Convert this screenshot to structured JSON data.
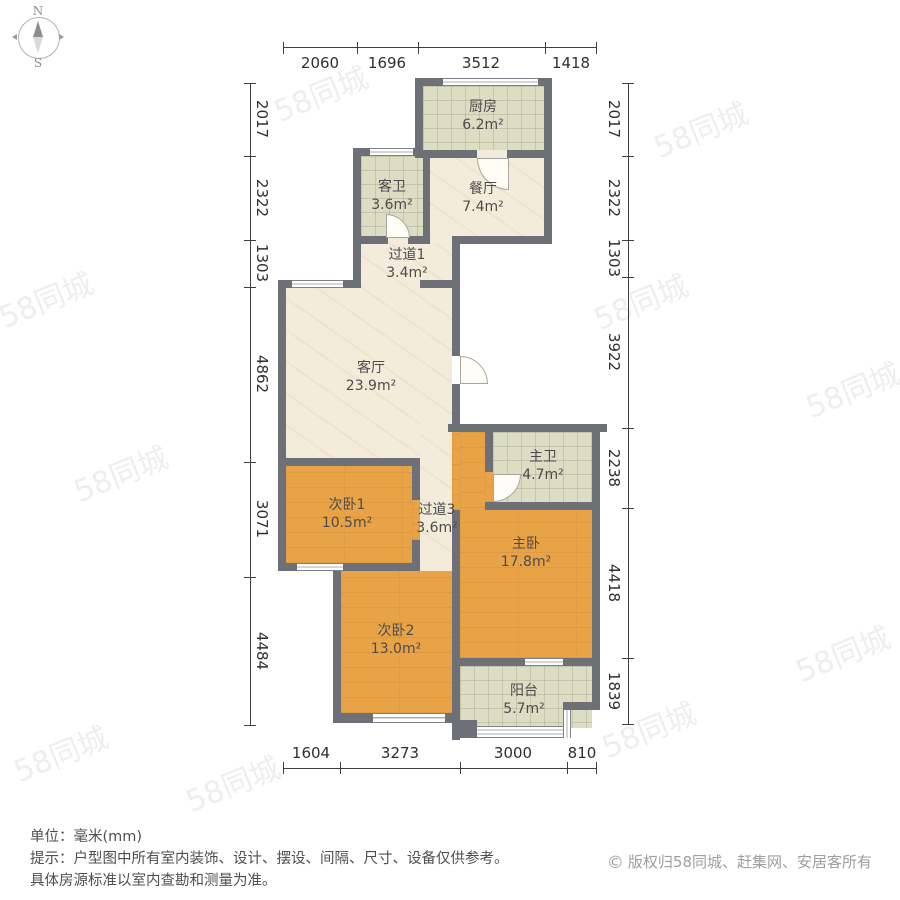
{
  "compass": {
    "north": "N",
    "south": "S"
  },
  "watermark": {
    "text": "58同城"
  },
  "colors": {
    "wall": "#6d7177",
    "wood_floor": "#e8a347",
    "tile_floor": "#dcddc3",
    "marble_floor": "#f3ecda",
    "dimension_text": "#2f2f2f",
    "footer_text": "#4f4f4f",
    "copyright_text": "#9e9e9e"
  },
  "rooms": {
    "kitchen": {
      "name": "厨房",
      "area": "6.2m²"
    },
    "guest_bath": {
      "name": "客卫",
      "area": "3.6m²"
    },
    "dining": {
      "name": "餐厅",
      "area": "7.4m²"
    },
    "hallway1": {
      "name": "过道1",
      "area": "3.4m²"
    },
    "living": {
      "name": "客厅",
      "area": "23.9m²"
    },
    "bedroom1": {
      "name": "次卧1",
      "area": "10.5m²"
    },
    "hallway3": {
      "name": "过道3",
      "area": "3.6m²"
    },
    "master_bath": {
      "name": "主卫",
      "area": "4.7m²"
    },
    "master_bedroom": {
      "name": "主卧",
      "area": "17.8m²"
    },
    "bedroom2": {
      "name": "次卧2",
      "area": "13.0m²"
    },
    "balcony": {
      "name": "阳台",
      "area": "5.7m²"
    }
  },
  "dims": {
    "top": [
      "2060",
      "1696",
      "3512",
      "1418"
    ],
    "bottom": [
      "1604",
      "3273",
      "3000",
      "810"
    ],
    "left": [
      "2017",
      "2322",
      "1303",
      "4862",
      "3071",
      "4484"
    ],
    "right": [
      "2017",
      "2322",
      "1303",
      "3922",
      "2238",
      "4418",
      "1839"
    ]
  },
  "footer": {
    "unit_line": "单位：毫米(mm)",
    "tip_line1": "提示：户型图中所有室内装饰、设计、摆设、间隔、尺寸、设备仅供参考。",
    "tip_line2": "具体房源标准以室内查勘和测量为准。",
    "copyright_symbol": "©",
    "copyright": "版权归58同城、赶集网、安居客所有"
  }
}
